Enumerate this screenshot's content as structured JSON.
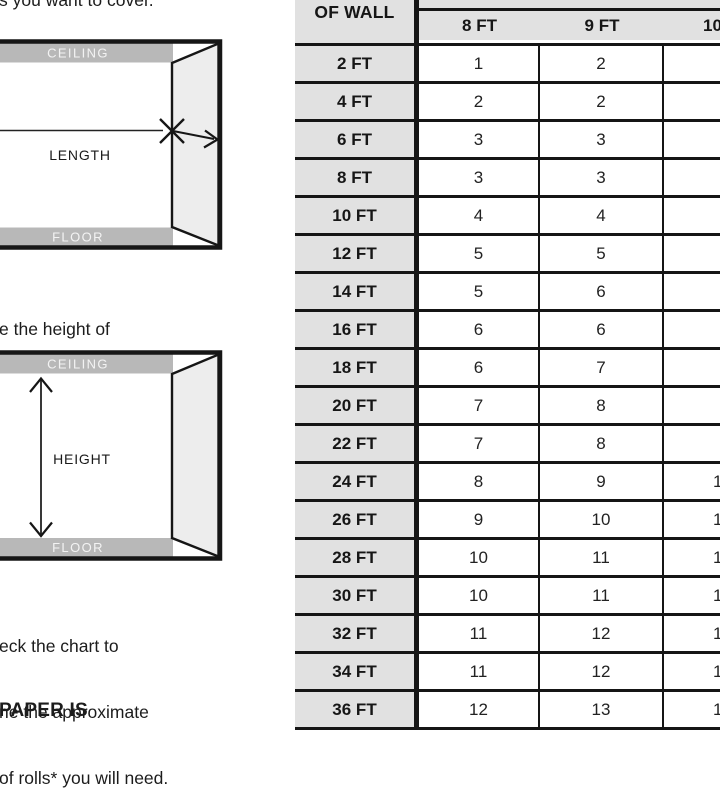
{
  "document": {
    "top_text_fragment": "s you want to cover.",
    "mid_text_fragment": {
      "line1": "e the height of",
      "line2": "ling."
    },
    "bottom_text_fragment": {
      "line1": "eck the chart to",
      "line2": "ne the approximate",
      "line3": "of rolls* you will need."
    },
    "footer_text_fragment": "PAPER IS"
  },
  "diagrams": {
    "length": {
      "ceiling": "CEILING",
      "floor": "FLOOR",
      "label": "LENGTH"
    },
    "height": {
      "ceiling": "CEILING",
      "floor": "FLOOR",
      "label": "HEIGHT"
    }
  },
  "table": {
    "corner_header": "OF WALL",
    "columns": {
      "c8": "8 FT",
      "c9": "9 FT",
      "c10": "10"
    },
    "rows": [
      {
        "label": "2 FT",
        "v8": "1",
        "v9": "2",
        "v10": ""
      },
      {
        "label": "4 FT",
        "v8": "2",
        "v9": "2",
        "v10": ""
      },
      {
        "label": "6 FT",
        "v8": "3",
        "v9": "3",
        "v10": ""
      },
      {
        "label": "8 FT",
        "v8": "3",
        "v9": "3",
        "v10": ""
      },
      {
        "label": "10 FT",
        "v8": "4",
        "v9": "4",
        "v10": ""
      },
      {
        "label": "12 FT",
        "v8": "5",
        "v9": "5",
        "v10": ""
      },
      {
        "label": "14 FT",
        "v8": "5",
        "v9": "6",
        "v10": ""
      },
      {
        "label": "16 FT",
        "v8": "6",
        "v9": "6",
        "v10": ""
      },
      {
        "label": "18 FT",
        "v8": "6",
        "v9": "7",
        "v10": ""
      },
      {
        "label": "20 FT",
        "v8": "7",
        "v9": "8",
        "v10": ""
      },
      {
        "label": "22 FT",
        "v8": "7",
        "v9": "8",
        "v10": ""
      },
      {
        "label": "24 FT",
        "v8": "8",
        "v9": "9",
        "v10": "1"
      },
      {
        "label": "26 FT",
        "v8": "9",
        "v9": "10",
        "v10": "1"
      },
      {
        "label": "28 FT",
        "v8": "10",
        "v9": "11",
        "v10": "1"
      },
      {
        "label": "30 FT",
        "v8": "10",
        "v9": "11",
        "v10": "1"
      },
      {
        "label": "32 FT",
        "v8": "11",
        "v9": "12",
        "v10": "1"
      },
      {
        "label": "34 FT",
        "v8": "11",
        "v9": "12",
        "v10": "1"
      },
      {
        "label": "36 FT",
        "v8": "12",
        "v9": "13",
        "v10": "1"
      }
    ]
  },
  "colors": {
    "table_gray": "#e1e1e1",
    "band_gray": "#b8b8b8",
    "side_wall_gray": "#ededed",
    "line_black": "#151515",
    "text": "#1c1c1c"
  }
}
